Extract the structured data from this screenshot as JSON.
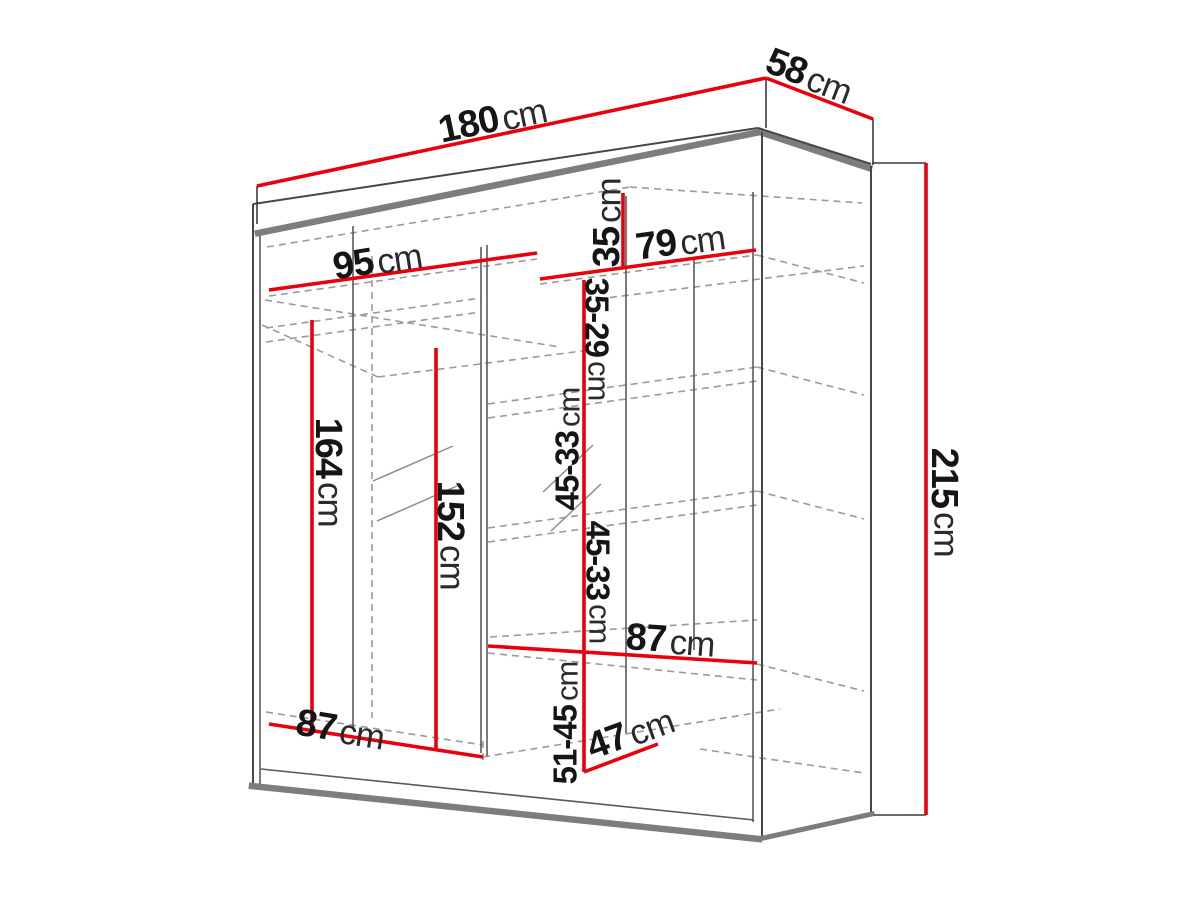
{
  "diagram": {
    "title": "Sliding-door wardrobe dimension drawing",
    "type": "furniture-dimension-diagram",
    "unit_system": "cm",
    "colors": {
      "dimension_line": "#e8000d",
      "carcass_line": "#7d7d7d",
      "hidden_line": "#9a9a9a",
      "label_text": "#151515"
    },
    "overall": {
      "width": "180",
      "depth": "58",
      "height": "215"
    },
    "dimensions": [
      {
        "id": "overall-width",
        "value": "180",
        "unit": "cm"
      },
      {
        "id": "overall-depth",
        "value": "58",
        "unit": "cm"
      },
      {
        "id": "overall-height",
        "value": "215",
        "unit": "cm"
      },
      {
        "id": "left-section-width",
        "value": "95",
        "unit": "cm"
      },
      {
        "id": "top-shelf-width",
        "value": "79",
        "unit": "cm"
      },
      {
        "id": "top-shelf-drop",
        "value": "35",
        "unit": "cm"
      },
      {
        "id": "shelf-gap-upper",
        "value": "35-29",
        "unit": "cm"
      },
      {
        "id": "shelf-gap-middle",
        "value": "45-33",
        "unit": "cm"
      },
      {
        "id": "shelf-gap-lower",
        "value": "45-33",
        "unit": "cm"
      },
      {
        "id": "hanging-space-left",
        "value": "164",
        "unit": "cm"
      },
      {
        "id": "hanging-space-center",
        "value": "152",
        "unit": "cm"
      },
      {
        "id": "bottom-left-width",
        "value": "87",
        "unit": "cm"
      },
      {
        "id": "right-shelf-width",
        "value": "87",
        "unit": "cm"
      },
      {
        "id": "bottom-gap",
        "value": "51-45",
        "unit": "cm"
      },
      {
        "id": "bottom-right-width",
        "value": "47",
        "unit": "cm"
      }
    ]
  }
}
